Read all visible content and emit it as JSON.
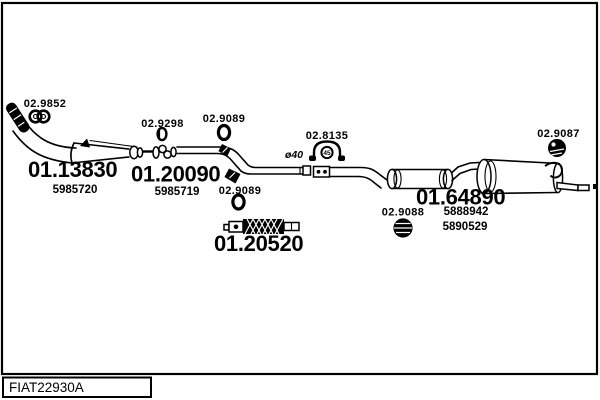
{
  "colors": {
    "ink": "#000000",
    "paper": "#ffffff"
  },
  "footer": {
    "code": "FIAT22930A"
  },
  "parts": {
    "front_pipe": {
      "part_no": "01.13830",
      "oem": "5985720"
    },
    "center_pipe": {
      "part_no": "01.20090",
      "oem": "5985719"
    },
    "flex_pipe": {
      "part_no": "01.20520"
    },
    "rear_silencer": {
      "part_no": "01.64890",
      "oem_1": "5888942",
      "oem_2": "5890529"
    }
  },
  "fittings": {
    "gasket": {
      "ref": "02.9852"
    },
    "seal_ring": {
      "ref": "02.9298"
    },
    "oring_front": {
      "ref": "02.9089"
    },
    "oring_mid": {
      "ref": "02.9089"
    },
    "clamp": {
      "ref": "02.8135",
      "stamp": "45"
    },
    "mount_center": {
      "ref": "02.9088"
    },
    "mount_rear": {
      "ref": "02.9087"
    }
  },
  "annotations": {
    "pipe_diameter": "ø40"
  }
}
